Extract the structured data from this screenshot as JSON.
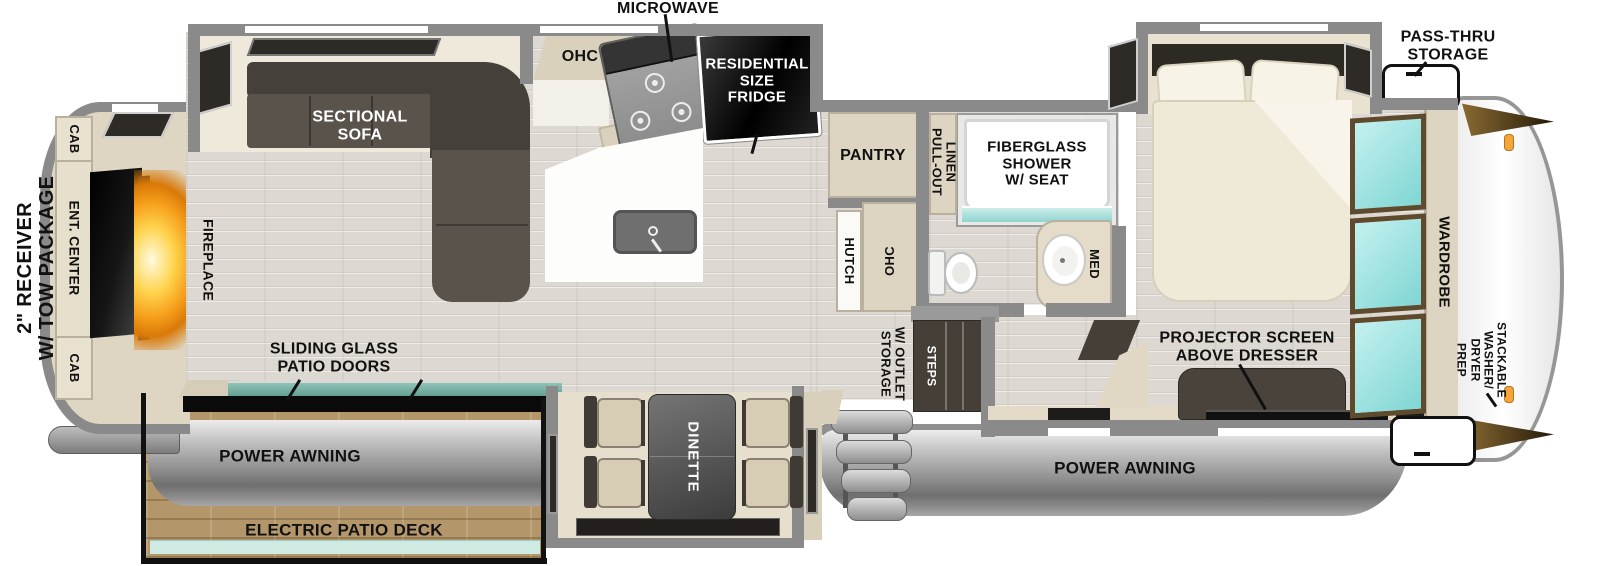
{
  "exterior": {
    "receiver_line1": "2\" RECEIVER",
    "receiver_line2": "W/ TOW PACKAGE",
    "pass_thru_line1": "PASS-THRU",
    "pass_thru_line2": "STORAGE",
    "power_awning_left": "POWER AWNING",
    "power_awning_right": "POWER AWNING",
    "electric_patio_deck": "ELECTRIC PATIO DECK"
  },
  "living_room": {
    "sofa_line1": "SECTIONAL",
    "sofa_line2": "SOFA",
    "cab_top": "CAB",
    "cab_bottom": "CAB",
    "ent_center": "ENT. CENTER",
    "fireplace": "FIREPLACE",
    "patio_doors_line1": "SLIDING GLASS",
    "patio_doors_line2": "PATIO DOORS"
  },
  "kitchen": {
    "microwave": "MICROWAVE",
    "ohc": "OHC",
    "fridge_line1": "RESIDENTIAL",
    "fridge_line2": "SIZE",
    "fridge_line3": "FRIDGE",
    "pantry": "PANTRY",
    "hutch": "HUTCH",
    "hutch_ohc": "OHC"
  },
  "dinette": {
    "label": "DINETTE"
  },
  "bathroom": {
    "pull_out_line1": "PULL-OUT",
    "pull_out_line2": "LINEN",
    "shower_line1": "FIBERGLASS",
    "shower_line2": "SHOWER",
    "shower_line3": "W/ SEAT",
    "med": "MED"
  },
  "entry": {
    "storage_outlet_line1": "STORAGE",
    "storage_outlet_line2": "W/ OUTLET",
    "steps": "STEPS"
  },
  "bedroom": {
    "projector_line1": "PROJECTOR SCREEN",
    "projector_line2": "ABOVE DRESSER",
    "wardrobe": "WARDROBE",
    "washer_line1": "STACKABLE",
    "washer_line2": "WASHER/",
    "washer_line3": "DRYER",
    "washer_line4": "PREP"
  },
  "colors": {
    "wall_gray": "#8a8a8a",
    "cabinet_tan": "#ddd5c1",
    "furniture_dark": "#4e4841",
    "floor_wood": "#ddd8d1",
    "mirror_teal": "#9be2e2",
    "shower_teal": "#9fd8d3",
    "patio_glass_teal": "#74b0a4",
    "deck_wood": "#b3976a",
    "awning_gray": "#909090",
    "marker_orange": "#f2a13a",
    "label_black": "#111111"
  }
}
